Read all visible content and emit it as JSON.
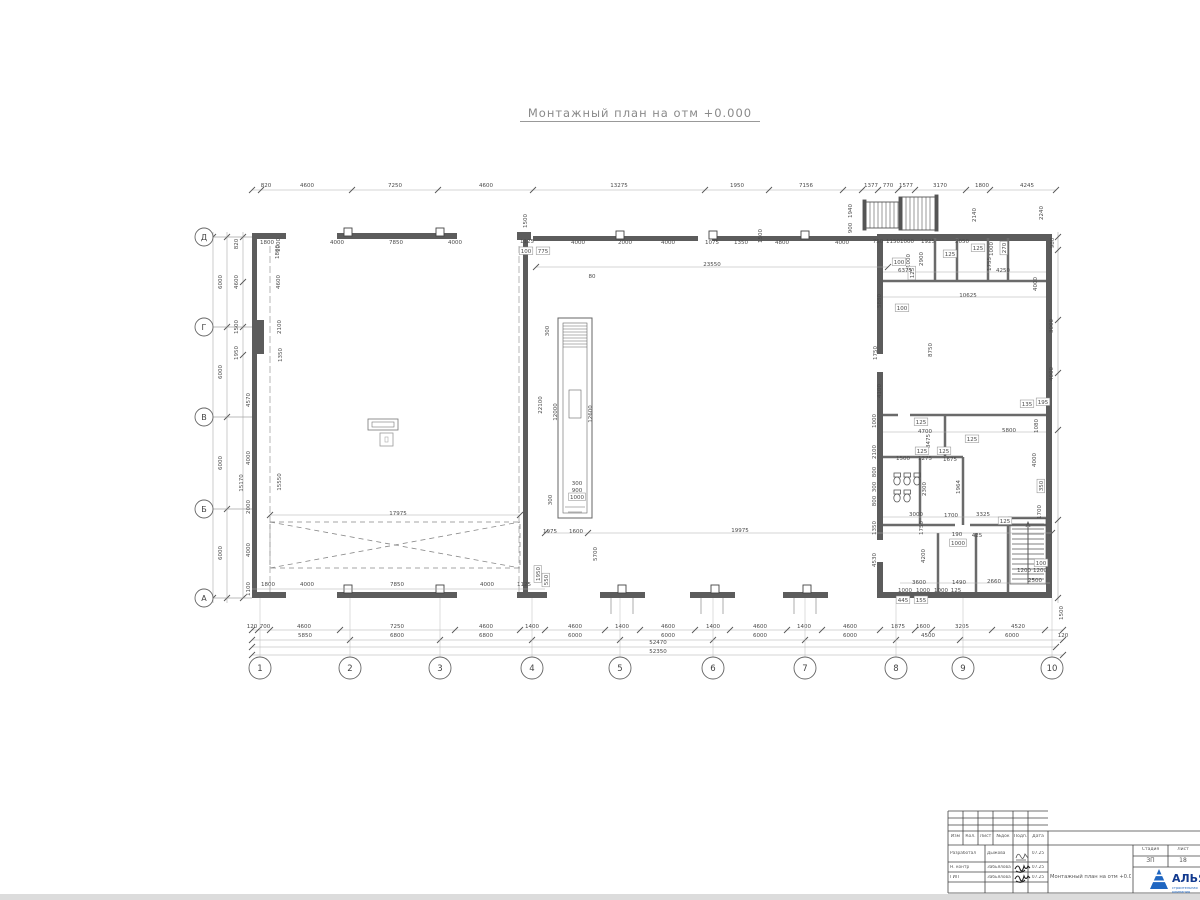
{
  "title": "Монтажный план на отм +0.000",
  "plan": {
    "axes_left": [
      {
        "label": "Д",
        "y": 237
      },
      {
        "label": "Г",
        "y": 327
      },
      {
        "label": "В",
        "y": 417
      },
      {
        "label": "Б",
        "y": 509
      },
      {
        "label": "А",
        "y": 598
      }
    ],
    "axes_bottom": [
      {
        "label": "1",
        "x": 260
      },
      {
        "label": "2",
        "x": 350
      },
      {
        "label": "3",
        "x": 440
      },
      {
        "label": "4",
        "x": 532
      },
      {
        "label": "5",
        "x": 620
      },
      {
        "label": "6",
        "x": 713
      },
      {
        "label": "7",
        "x": 805
      },
      {
        "label": "8",
        "x": 896
      },
      {
        "label": "9",
        "x": 963
      },
      {
        "label": "10",
        "x": 1052
      }
    ],
    "dims": [
      {
        "t": "820",
        "x": 266,
        "y": 187
      },
      {
        "t": "4600",
        "x": 307,
        "y": 187
      },
      {
        "t": "7250",
        "x": 395,
        "y": 187
      },
      {
        "t": "4600",
        "x": 486,
        "y": 187
      },
      {
        "t": "13275",
        "x": 619,
        "y": 187
      },
      {
        "t": "1950",
        "x": 737,
        "y": 187
      },
      {
        "t": "7156",
        "x": 806,
        "y": 187
      },
      {
        "t": "1377",
        "x": 871,
        "y": 187
      },
      {
        "t": "770",
        "x": 888,
        "y": 187
      },
      {
        "t": "1577",
        "x": 906,
        "y": 187
      },
      {
        "t": "3170",
        "x": 940,
        "y": 187
      },
      {
        "t": "1800",
        "x": 982,
        "y": 187
      },
      {
        "t": "4245",
        "x": 1027,
        "y": 187
      },
      {
        "t": "1800",
        "x": 267,
        "y": 244
      },
      {
        "t": "1800",
        "x": 279,
        "y": 252,
        "r": 1
      },
      {
        "t": "4000",
        "x": 337,
        "y": 244
      },
      {
        "t": "7850",
        "x": 396,
        "y": 244
      },
      {
        "t": "4000",
        "x": 455,
        "y": 244
      },
      {
        "t": "1125",
        "x": 527,
        "y": 243
      },
      {
        "t": "100",
        "x": 526,
        "y": 253,
        "b": 1
      },
      {
        "t": "775",
        "x": 543,
        "y": 253,
        "b": 1
      },
      {
        "t": "4000",
        "x": 578,
        "y": 244
      },
      {
        "t": "2000",
        "x": 625,
        "y": 244
      },
      {
        "t": "4000",
        "x": 668,
        "y": 244
      },
      {
        "t": "1075",
        "x": 712,
        "y": 244
      },
      {
        "t": "1350",
        "x": 741,
        "y": 244
      },
      {
        "t": "4800",
        "x": 782,
        "y": 244
      },
      {
        "t": "4000",
        "x": 842,
        "y": 244
      },
      {
        "t": "750",
        "x": 878,
        "y": 243
      },
      {
        "t": "1150",
        "x": 893,
        "y": 243
      },
      {
        "t": "1000",
        "x": 907,
        "y": 243
      },
      {
        "t": "1925",
        "x": 928,
        "y": 243
      },
      {
        "t": "2050",
        "x": 962,
        "y": 243
      },
      {
        "t": "125",
        "x": 978,
        "y": 250,
        "b": 1
      },
      {
        "t": "125",
        "x": 950,
        "y": 256,
        "b": 1
      },
      {
        "t": "270",
        "x": 1006,
        "y": 248,
        "r": 1,
        "b": 1
      },
      {
        "t": "1000",
        "x": 993,
        "y": 249,
        "r": 1
      },
      {
        "t": "1755",
        "x": 991,
        "y": 264,
        "r": 1
      },
      {
        "t": "980",
        "x": 1054,
        "y": 243,
        "r": 1
      },
      {
        "t": "1500",
        "x": 527,
        "y": 221,
        "r": 1
      },
      {
        "t": "1500",
        "x": 762,
        "y": 236,
        "r": 1
      },
      {
        "t": "23550",
        "x": 712,
        "y": 266
      },
      {
        "t": "80",
        "x": 592,
        "y": 278
      },
      {
        "t": "2140",
        "x": 976,
        "y": 215,
        "r": 1
      },
      {
        "t": "2240",
        "x": 1043,
        "y": 213,
        "r": 1
      },
      {
        "t": "1940",
        "x": 852,
        "y": 211,
        "r": 1
      },
      {
        "t": "900",
        "x": 852,
        "y": 228,
        "r": 1
      },
      {
        "t": "1000",
        "x": 910,
        "y": 261,
        "r": 1
      },
      {
        "t": "100",
        "x": 899,
        "y": 264,
        "b": 1
      },
      {
        "t": "2900",
        "x": 923,
        "y": 259,
        "r": 1
      },
      {
        "t": "125",
        "x": 914,
        "y": 273,
        "r": 1,
        "b": 1
      },
      {
        "t": "6375",
        "x": 905,
        "y": 272
      },
      {
        "t": "4250",
        "x": 1003,
        "y": 272
      },
      {
        "t": "10625",
        "x": 968,
        "y": 297
      },
      {
        "t": "100",
        "x": 902,
        "y": 310,
        "b": 1
      },
      {
        "t": "5880",
        "x": 881,
        "y": 301,
        "r": 1
      },
      {
        "t": "8750",
        "x": 932,
        "y": 350,
        "r": 1
      },
      {
        "t": "1750",
        "x": 877,
        "y": 353,
        "r": 1
      },
      {
        "t": "4100",
        "x": 881,
        "y": 391,
        "r": 1
      },
      {
        "t": "4000",
        "x": 1037,
        "y": 284,
        "r": 1
      },
      {
        "t": "3000",
        "x": 1053,
        "y": 326,
        "r": 1
      },
      {
        "t": "4000",
        "x": 1053,
        "y": 374,
        "r": 1
      },
      {
        "t": "135",
        "x": 1027,
        "y": 406,
        "b": 1
      },
      {
        "t": "195",
        "x": 1043,
        "y": 404,
        "b": 1
      },
      {
        "t": "4700",
        "x": 925,
        "y": 433
      },
      {
        "t": "5800",
        "x": 1009,
        "y": 432
      },
      {
        "t": "125",
        "x": 921,
        "y": 424,
        "b": 1
      },
      {
        "t": "3475",
        "x": 930,
        "y": 441,
        "r": 1
      },
      {
        "t": "125",
        "x": 972,
        "y": 441,
        "b": 1
      },
      {
        "t": "1500",
        "x": 903,
        "y": 460
      },
      {
        "t": "1275",
        "x": 925,
        "y": 460
      },
      {
        "t": "1675",
        "x": 950,
        "y": 461
      },
      {
        "t": "125",
        "x": 922,
        "y": 453,
        "b": 1
      },
      {
        "t": "125",
        "x": 944,
        "y": 453,
        "b": 1
      },
      {
        "t": "2300",
        "x": 926,
        "y": 489,
        "r": 1
      },
      {
        "t": "1964",
        "x": 960,
        "y": 487,
        "r": 1
      },
      {
        "t": "3000",
        "x": 916,
        "y": 516
      },
      {
        "t": "1700",
        "x": 951,
        "y": 517
      },
      {
        "t": "3325",
        "x": 983,
        "y": 516
      },
      {
        "t": "125",
        "x": 1005,
        "y": 523,
        "b": 1
      },
      {
        "t": "1750",
        "x": 923,
        "y": 528,
        "r": 1
      },
      {
        "t": "190",
        "x": 957,
        "y": 536
      },
      {
        "t": "1000",
        "x": 958,
        "y": 545,
        "b": 1
      },
      {
        "t": "425",
        "x": 977,
        "y": 537
      },
      {
        "t": "4200",
        "x": 925,
        "y": 556,
        "r": 1
      },
      {
        "t": "3600",
        "x": 919,
        "y": 584
      },
      {
        "t": "1490",
        "x": 959,
        "y": 584
      },
      {
        "t": "2660",
        "x": 994,
        "y": 583
      },
      {
        "t": "2500",
        "x": 1035,
        "y": 582
      },
      {
        "t": "1200",
        "x": 1024,
        "y": 572
      },
      {
        "t": "1200",
        "x": 1040,
        "y": 572
      },
      {
        "t": "100",
        "x": 1041,
        "y": 565,
        "b": 1
      },
      {
        "t": "1000",
        "x": 905,
        "y": 592
      },
      {
        "t": "1000",
        "x": 923,
        "y": 592
      },
      {
        "t": "1000",
        "x": 941,
        "y": 592
      },
      {
        "t": "125",
        "x": 956,
        "y": 592
      },
      {
        "t": "445",
        "x": 903,
        "y": 602,
        "b": 1
      },
      {
        "t": "155",
        "x": 921,
        "y": 602,
        "b": 1
      },
      {
        "t": "1080",
        "x": 1038,
        "y": 426,
        "r": 1
      },
      {
        "t": "4000",
        "x": 1036,
        "y": 460,
        "r": 1
      },
      {
        "t": "350",
        "x": 1043,
        "y": 486,
        "r": 1,
        "b": 1
      },
      {
        "t": "1700",
        "x": 1041,
        "y": 512,
        "r": 1
      },
      {
        "t": "1000",
        "x": 876,
        "y": 421,
        "r": 1
      },
      {
        "t": "2100",
        "x": 876,
        "y": 452,
        "r": 1
      },
      {
        "t": "800",
        "x": 876,
        "y": 472,
        "r": 1
      },
      {
        "t": "300",
        "x": 876,
        "y": 487,
        "r": 1
      },
      {
        "t": "800",
        "x": 876,
        "y": 501,
        "r": 1
      },
      {
        "t": "1350",
        "x": 876,
        "y": 528,
        "r": 1
      },
      {
        "t": "4530",
        "x": 876,
        "y": 560,
        "r": 1
      },
      {
        "t": "22100",
        "x": 542,
        "y": 405,
        "r": 1
      },
      {
        "t": "12000",
        "x": 557,
        "y": 412,
        "r": 1
      },
      {
        "t": "12600",
        "x": 592,
        "y": 414,
        "r": 1
      },
      {
        "t": "300",
        "x": 549,
        "y": 331,
        "r": 1
      },
      {
        "t": "300",
        "x": 577,
        "y": 485
      },
      {
        "t": "900",
        "x": 577,
        "y": 492
      },
      {
        "t": "1000",
        "x": 577,
        "y": 499,
        "b": 1
      },
      {
        "t": "300",
        "x": 552,
        "y": 500,
        "r": 1
      },
      {
        "t": "1975",
        "x": 550,
        "y": 533
      },
      {
        "t": "1600",
        "x": 576,
        "y": 533
      },
      {
        "t": "19975",
        "x": 740,
        "y": 532
      },
      {
        "t": "5700",
        "x": 597,
        "y": 554,
        "r": 1
      },
      {
        "t": "1950",
        "x": 540,
        "y": 574,
        "r": 1,
        "b": 1
      },
      {
        "t": "550",
        "x": 548,
        "y": 580,
        "r": 1,
        "b": 1
      },
      {
        "t": "17975",
        "x": 398,
        "y": 515
      },
      {
        "t": "1800",
        "x": 268,
        "y": 586
      },
      {
        "t": "4000",
        "x": 307,
        "y": 586
      },
      {
        "t": "7850",
        "x": 397,
        "y": 586
      },
      {
        "t": "4000",
        "x": 487,
        "y": 586
      },
      {
        "t": "1125",
        "x": 524,
        "y": 586
      },
      {
        "t": "1100",
        "x": 250,
        "y": 589,
        "r": 1
      },
      {
        "t": "24240",
        "x": 207,
        "y": 416,
        "r": 1
      },
      {
        "t": "6000",
        "x": 222,
        "y": 282,
        "r": 1
      },
      {
        "t": "6000",
        "x": 222,
        "y": 372,
        "r": 1
      },
      {
        "t": "6000",
        "x": 222,
        "y": 463,
        "r": 1
      },
      {
        "t": "6000",
        "x": 222,
        "y": 553,
        "r": 1
      },
      {
        "t": "820",
        "x": 238,
        "y": 244,
        "r": 1
      },
      {
        "t": "4600",
        "x": 238,
        "y": 282,
        "r": 1
      },
      {
        "t": "1500",
        "x": 238,
        "y": 327,
        "r": 1
      },
      {
        "t": "1950",
        "x": 238,
        "y": 353,
        "r": 1
      },
      {
        "t": "4570",
        "x": 250,
        "y": 400,
        "r": 1
      },
      {
        "t": "4000",
        "x": 250,
        "y": 458,
        "r": 1
      },
      {
        "t": "2000",
        "x": 250,
        "y": 507,
        "r": 1
      },
      {
        "t": "4000",
        "x": 250,
        "y": 550,
        "r": 1
      },
      {
        "t": "15170",
        "x": 243,
        "y": 483,
        "r": 1
      },
      {
        "t": "1000",
        "x": 280,
        "y": 245,
        "r": 1
      },
      {
        "t": "4600",
        "x": 280,
        "y": 282,
        "r": 1
      },
      {
        "t": "2100",
        "x": 281,
        "y": 327,
        "r": 1
      },
      {
        "t": "1350",
        "x": 282,
        "y": 355,
        "r": 1
      },
      {
        "t": "15550",
        "x": 281,
        "y": 482,
        "r": 1
      },
      {
        "t": "120",
        "x": 252,
        "y": 628
      },
      {
        "t": "700",
        "x": 265,
        "y": 628
      },
      {
        "t": "4600",
        "x": 304,
        "y": 628
      },
      {
        "t": "7250",
        "x": 397,
        "y": 628
      },
      {
        "t": "4600",
        "x": 486,
        "y": 628
      },
      {
        "t": "1400",
        "x": 532,
        "y": 628
      },
      {
        "t": "4600",
        "x": 575,
        "y": 628
      },
      {
        "t": "1400",
        "x": 622,
        "y": 628
      },
      {
        "t": "4600",
        "x": 668,
        "y": 628
      },
      {
        "t": "1400",
        "x": 713,
        "y": 628
      },
      {
        "t": "4600",
        "x": 760,
        "y": 628
      },
      {
        "t": "1400",
        "x": 804,
        "y": 628
      },
      {
        "t": "4600",
        "x": 850,
        "y": 628
      },
      {
        "t": "1875",
        "x": 898,
        "y": 628
      },
      {
        "t": "1600",
        "x": 923,
        "y": 628
      },
      {
        "t": "3205",
        "x": 962,
        "y": 628
      },
      {
        "t": "4520",
        "x": 1018,
        "y": 628
      },
      {
        "t": "120",
        "x": 1063,
        "y": 637
      },
      {
        "t": "5850",
        "x": 305,
        "y": 637
      },
      {
        "t": "6800",
        "x": 397,
        "y": 637
      },
      {
        "t": "6800",
        "x": 486,
        "y": 637
      },
      {
        "t": "6000",
        "x": 575,
        "y": 637
      },
      {
        "t": "6000",
        "x": 668,
        "y": 637
      },
      {
        "t": "6000",
        "x": 760,
        "y": 637
      },
      {
        "t": "6000",
        "x": 850,
        "y": 637
      },
      {
        "t": "4500",
        "x": 928,
        "y": 637
      },
      {
        "t": "6000",
        "x": 1012,
        "y": 637
      },
      {
        "t": "52470",
        "x": 658,
        "y": 644
      },
      {
        "t": "52350",
        "x": 658,
        "y": 653
      },
      {
        "t": "1500",
        "x": 1063,
        "y": 613,
        "r": 1
      }
    ]
  },
  "titleblock": {
    "headers": [
      "Изм",
      "Кол.",
      "Лист",
      "№док",
      "Подп.",
      "Дата"
    ],
    "rows": [
      {
        "role": "Разработал",
        "name": "Дыжова",
        "date": "07.25"
      },
      {
        "role": "Н. контр",
        "name": "Забьялова",
        "date": "07.25"
      },
      {
        "role": "ГИП",
        "name": "Забьялова",
        "date": "07.25"
      }
    ],
    "doc_title": "Монтажный план на отм +0.000",
    "stage_label": "Стадия",
    "sheet_label": "Лист",
    "stage": "ЗП",
    "sheet": "18",
    "logo_text": "АЛЬЯ",
    "logo_sub": "строительная компания"
  }
}
